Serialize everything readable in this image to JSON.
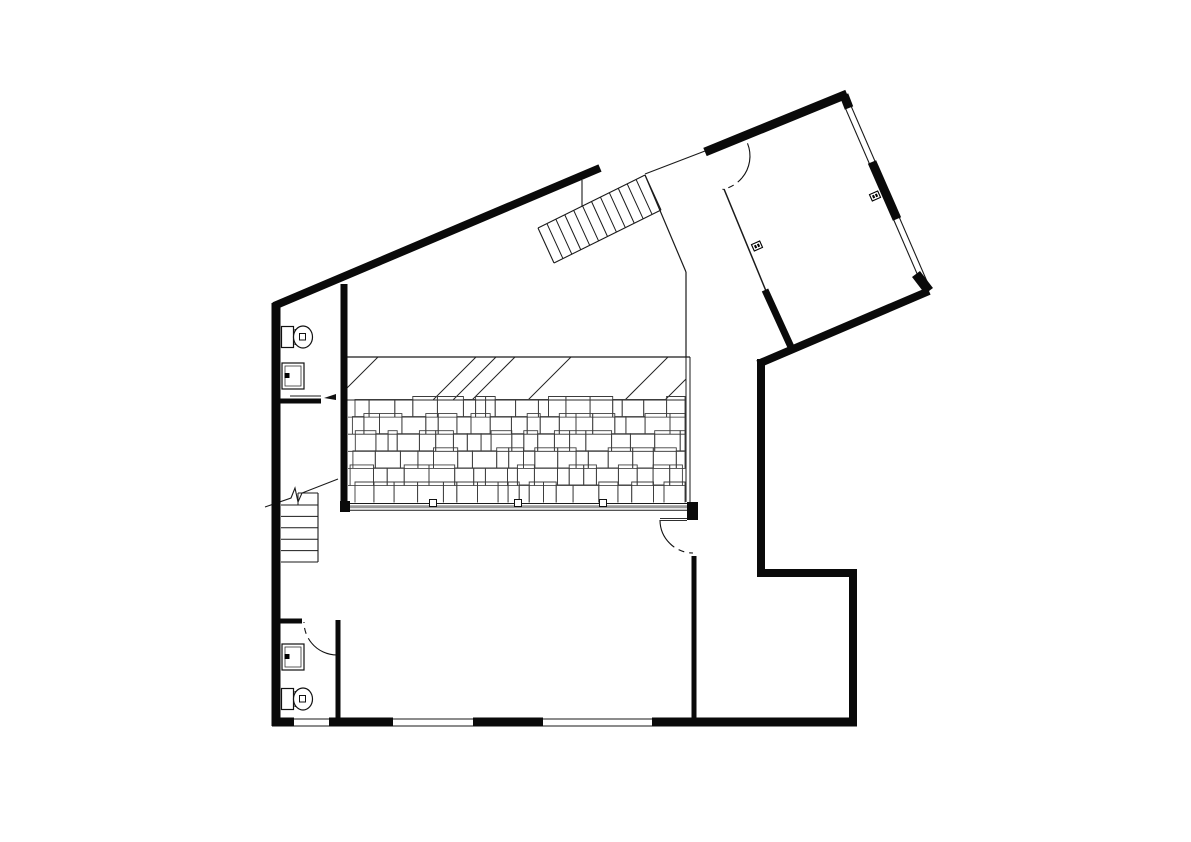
{
  "document": {
    "type": "architectural-floor-plan",
    "background_color": "#ffffff",
    "wall_color": "#0a0a0a",
    "thin_line_color": "#1a1a1a",
    "hatch_line_color": "#3c3c3c",
    "beam_mid_color": "#999999",
    "canvas": {
      "width": 1191,
      "height": 842
    }
  },
  "walls": [
    {
      "n": "wall-top-left-diagonal",
      "x1": 274,
      "y1": 306,
      "x2": 600,
      "y2": 168,
      "w": 8
    },
    {
      "n": "wall-left-vertical",
      "x1": 276,
      "y1": 303,
      "x2": 276,
      "y2": 726,
      "w": 9
    },
    {
      "n": "wall-bottom-seg-1",
      "x1": 272,
      "y1": 722,
      "x2": 294,
      "y2": 722,
      "w": 9
    },
    {
      "n": "wall-bottom-seg-2",
      "x1": 329,
      "y1": 722,
      "x2": 393,
      "y2": 722,
      "w": 9
    },
    {
      "n": "wall-bottom-seg-3",
      "x1": 473,
      "y1": 722,
      "x2": 543,
      "y2": 722,
      "w": 9
    },
    {
      "n": "wall-bottom-seg-4",
      "x1": 652,
      "y1": 722,
      "x2": 857,
      "y2": 722,
      "w": 9
    },
    {
      "n": "wall-right-lower-vertical",
      "x1": 853,
      "y1": 569,
      "x2": 853,
      "y2": 726,
      "w": 8
    },
    {
      "n": "wall-step-horizontal",
      "x1": 758,
      "y1": 573,
      "x2": 857,
      "y2": 573,
      "w": 8
    },
    {
      "n": "wall-right-mid-vertical",
      "x1": 761,
      "y1": 359,
      "x2": 761,
      "y2": 577,
      "w": 8
    },
    {
      "n": "wall-outer-northeast-diagonal",
      "x1": 929,
      "y1": 291,
      "x2": 758,
      "y2": 364,
      "w": 8
    },
    {
      "n": "wall-room-left-spur",
      "x1": 765,
      "y1": 290,
      "x2": 791,
      "y2": 347,
      "w": 7
    },
    {
      "n": "wall-room-top",
      "x1": 705,
      "y1": 152,
      "x2": 847,
      "y2": 94,
      "w": 9
    },
    {
      "n": "wall-window-stub-top",
      "x1": 844,
      "y1": 95,
      "x2": 849,
      "y2": 108,
      "w": 9
    },
    {
      "n": "wall-window-mid",
      "x1": 872,
      "y1": 162,
      "x2": 897,
      "y2": 219,
      "w": 9
    },
    {
      "n": "wall-window-stub-bottom",
      "x1": 916,
      "y1": 274,
      "x2": 929,
      "y2": 291,
      "w": 10
    },
    {
      "n": "wall-hall-left-interior",
      "x1": 344,
      "y1": 284,
      "x2": 344,
      "y2": 510,
      "w": 7
    },
    {
      "n": "wall-upper-bath-partition",
      "x1": 278,
      "y1": 401,
      "x2": 321,
      "y2": 401,
      "w": 5
    },
    {
      "n": "wall-lower-bath-vertical",
      "x1": 338,
      "y1": 620,
      "x2": 338,
      "y2": 726,
      "w": 5
    },
    {
      "n": "wall-lower-bath-partition",
      "x1": 272,
      "y1": 621,
      "x2": 302,
      "y2": 621,
      "w": 5
    },
    {
      "n": "wall-below-hall-door",
      "x1": 694,
      "y1": 556,
      "x2": 694,
      "y2": 726,
      "w": 5
    }
  ],
  "blocks": [
    {
      "n": "beam-end-block",
      "x": 687,
      "y": 502,
      "w": 11,
      "h": 18
    },
    {
      "n": "beam-left-block",
      "x": 340,
      "y": 501,
      "w": 10,
      "h": 11
    }
  ],
  "thin_lines": [
    {
      "n": "stair-wall-connector",
      "x1": 582,
      "y1": 180,
      "x2": 582,
      "y2": 206,
      "w": 1.1
    },
    {
      "n": "entry-threshold-line",
      "x1": 645,
      "y1": 174,
      "x2": 705,
      "y2": 151,
      "w": 1.1
    },
    {
      "n": "corridor-left-diagonal",
      "x1": 645,
      "y1": 175,
      "x2": 686,
      "y2": 272,
      "w": 1.2
    },
    {
      "n": "corridor-left-vertical",
      "x1": 686,
      "y1": 272,
      "x2": 686,
      "y2": 357,
      "w": 1.2
    },
    {
      "n": "deck-right-edge-outer",
      "x1": 686,
      "y1": 357,
      "x2": 686,
      "y2": 502,
      "w": 1
    },
    {
      "n": "deck-right-edge-inner",
      "x1": 690,
      "y1": 357,
      "x2": 690,
      "y2": 502,
      "w": 1
    },
    {
      "n": "room-left-thin-wall",
      "x1": 724,
      "y1": 189,
      "x2": 766,
      "y2": 291,
      "w": 1.5
    },
    {
      "n": "window-wall-line-outer",
      "x1": 848.8,
      "y1": 100.8,
      "x2": 929.8,
      "y2": 287.8,
      "w": 1.1
    },
    {
      "n": "window-wall-line-inner",
      "x1": 843.2,
      "y1": 103.2,
      "x2": 924.2,
      "y2": 290.2,
      "w": 1.1
    },
    {
      "n": "bottom-window-line-outer",
      "x1": 290,
      "y1": 719,
      "x2": 656,
      "y2": 719,
      "w": 1
    },
    {
      "n": "bottom-window-line-inner",
      "x1": 290,
      "y1": 726,
      "x2": 656,
      "y2": 726,
      "w": 1
    },
    {
      "n": "upper-bath-counter-line",
      "x1": 290,
      "y1": 396,
      "x2": 321,
      "y2": 396,
      "w": 1
    }
  ],
  "hatch": {
    "n": "roof-deck-hatch",
    "x0": 348,
    "x1": 686,
    "band_top_y": 357,
    "band_bottom_y": 400,
    "band_top_line": {
      "x1": 344,
      "y1": 357,
      "x2": 690,
      "y2": 357
    },
    "band_bottom_line": {
      "x1": 344,
      "y1": 400,
      "x2": 686,
      "y2": 400
    },
    "diagonals": [
      {
        "x1": 344,
        "y1": 391,
        "x2": 378,
        "y2": 357
      },
      {
        "x1": 433,
        "y1": 400,
        "x2": 476,
        "y2": 357
      },
      {
        "x1": 453,
        "y1": 400,
        "x2": 496,
        "y2": 357
      },
      {
        "x1": 472,
        "y1": 400,
        "x2": 515,
        "y2": 357
      },
      {
        "x1": 528,
        "y1": 400,
        "x2": 571,
        "y2": 357
      },
      {
        "x1": 625,
        "y1": 400,
        "x2": 668,
        "y2": 357
      },
      {
        "x1": 665,
        "y1": 400,
        "x2": 686,
        "y2": 379
      }
    ],
    "shingle_rows": 6,
    "row_height": 17.1,
    "seed": 7,
    "beam": {
      "top": {
        "x1": 344,
        "y1": 503.5,
        "x2": 697,
        "y2": 503.5,
        "w": 1
      },
      "mid": {
        "x1": 344,
        "y1": 506.8,
        "x2": 688,
        "y2": 506.8,
        "w": 3
      },
      "bottom": {
        "x1": 344,
        "y1": 510.3,
        "x2": 690,
        "y2": 510.3,
        "w": 1
      },
      "posts_x": [
        433,
        518,
        603
      ],
      "post_y": 499.5,
      "post_size": 7
    }
  },
  "exterior_stairs": {
    "n": "entry-stairs",
    "corners": {
      "A": [
        538,
        228
      ],
      "B": [
        645,
        175
      ],
      "C": [
        661,
        210
      ],
      "D": [
        554,
        263
      ]
    },
    "tread_count": 11
  },
  "interior_stairs": {
    "n": "hall-stairs",
    "left_x": 281,
    "right_x": 318,
    "right_edge": {
      "y1": 493,
      "y2": 562
    },
    "tread_ys": [
      505,
      516.4,
      527.8,
      539.2,
      550.6,
      562
    ],
    "top_edge": {
      "x1": 298,
      "y1": 493,
      "x2": 318,
      "y2": 493
    },
    "top_partial_vertical": {
      "x1": 298,
      "y1": 493,
      "x2": 298,
      "y2": 505
    },
    "break_line_points": [
      [
        265,
        507
      ],
      [
        291,
        498
      ],
      [
        295,
        488
      ],
      [
        298,
        502
      ],
      [
        302,
        493
      ],
      [
        338,
        479
      ]
    ]
  },
  "doors": [
    {
      "n": "entry-door-arc",
      "cx": 716,
      "cy": 156,
      "r": 34,
      "solid": [
        -22,
        40
      ],
      "dashed": [
        40,
        79
      ]
    },
    {
      "n": "hall-door-arc",
      "cx": 693,
      "cy": 520,
      "r": 33,
      "solid": [
        180,
        135
      ],
      "dashed": [
        135,
        90
      ],
      "leaf": {
        "x1": 660,
        "y1": 519.5,
        "x2": 687,
        "y2": 519.5
      }
    },
    {
      "n": "lower-bath-door-arc",
      "cx": 337,
      "cy": 622,
      "r": 33,
      "solid": [
        90,
        140
      ],
      "dashed": [
        140,
        180
      ]
    }
  ],
  "fixtures": {
    "toilets": [
      {
        "n": "toilet-upper",
        "tank": [
          281.5,
          326.5,
          12,
          21
        ],
        "divider": [
          295,
          329,
          295,
          345
        ],
        "bowl": {
          "cx": 303,
          "cy": 337,
          "rx": 9.5,
          "ry": 11
        },
        "inner": [
          299.5,
          333.5,
          6,
          6.5
        ]
      },
      {
        "n": "toilet-lower",
        "tank": [
          281.5,
          688.5,
          12,
          21
        ],
        "divider": [
          295,
          691,
          295,
          707
        ],
        "bowl": {
          "cx": 303,
          "cy": 699,
          "rx": 9.5,
          "ry": 11
        },
        "inner": [
          299.5,
          695.5,
          6,
          6.5
        ]
      }
    ],
    "sinks": [
      {
        "n": "sink-upper",
        "outer": [
          282,
          363,
          22,
          26
        ],
        "inner": [
          285,
          366,
          16,
          20
        ],
        "tap": [
          284.5,
          373,
          5,
          5
        ]
      },
      {
        "n": "sink-lower",
        "outer": [
          282,
          644,
          22,
          26
        ],
        "inner": [
          285,
          647,
          16,
          20
        ],
        "tap": [
          284.5,
          654,
          5,
          5
        ]
      }
    ],
    "outlets": [
      {
        "n": "outlet-room-left-wall",
        "cx": 757,
        "cy": 246,
        "rot": -24
      },
      {
        "n": "outlet-room-right-wall",
        "cx": 875,
        "cy": 196,
        "rot": -24
      }
    ],
    "door_arrow": {
      "n": "upper-bath-opening-arrow",
      "points": [
        [
          336,
          394
        ],
        [
          324,
          398
        ],
        [
          336,
          400
        ]
      ]
    }
  }
}
